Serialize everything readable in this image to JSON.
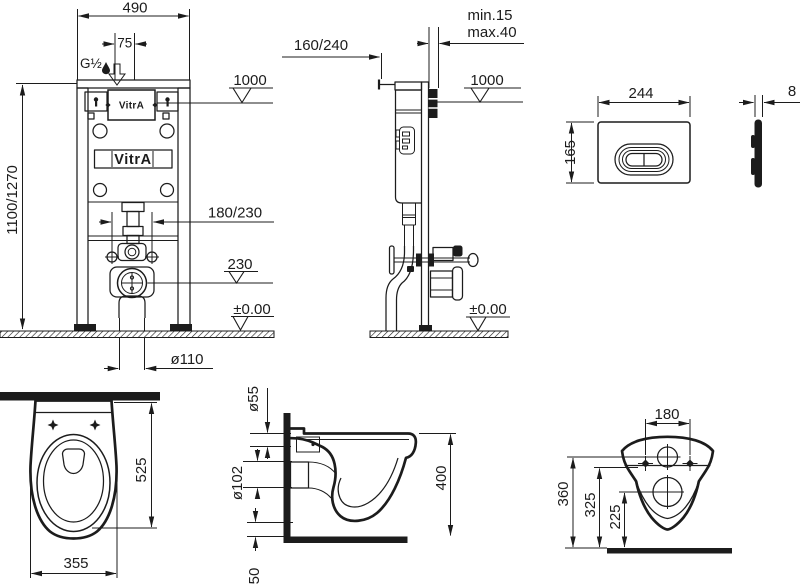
{
  "colors": {
    "ink": "#1c1c1c",
    "paper": "#ffffff"
  },
  "brand": {
    "cistern_logo": "VitrA",
    "plate_logo": "VitrA"
  },
  "frame_front_view": {
    "width_mm": "490",
    "inlet_offset_mm": "75",
    "water_inlet_thread": "G½",
    "plate_height_level": "1000",
    "frame_height_mm": "1100/1270",
    "fixing_bolt_spacing": "180/230",
    "outlet_center_level": "230",
    "floor_level": "±0.00",
    "drain_diameter": "ø110"
  },
  "frame_side_view": {
    "frame_depth_mm": "160/240",
    "wall_finish_min": "min.15",
    "wall_finish_max": "max.40",
    "plate_height_level": "1000",
    "floor_level": "±0.00"
  },
  "flush_plate_view": {
    "width_mm": "244",
    "height_mm": "165",
    "thickness_mm": "8"
  },
  "pan_top_view": {
    "depth_mm": "525",
    "width_mm": "355"
  },
  "pan_side_view": {
    "flush_inlet_diameter": "ø55",
    "outlet_diameter": "ø102",
    "rim_height_mm": "400",
    "outlet_offset_mm": "50"
  },
  "pan_rear_view": {
    "bolt_hole_spacing": "180",
    "inlet_height_mm": "360",
    "bolt_height_mm": "325",
    "outlet_height_mm": "225"
  }
}
